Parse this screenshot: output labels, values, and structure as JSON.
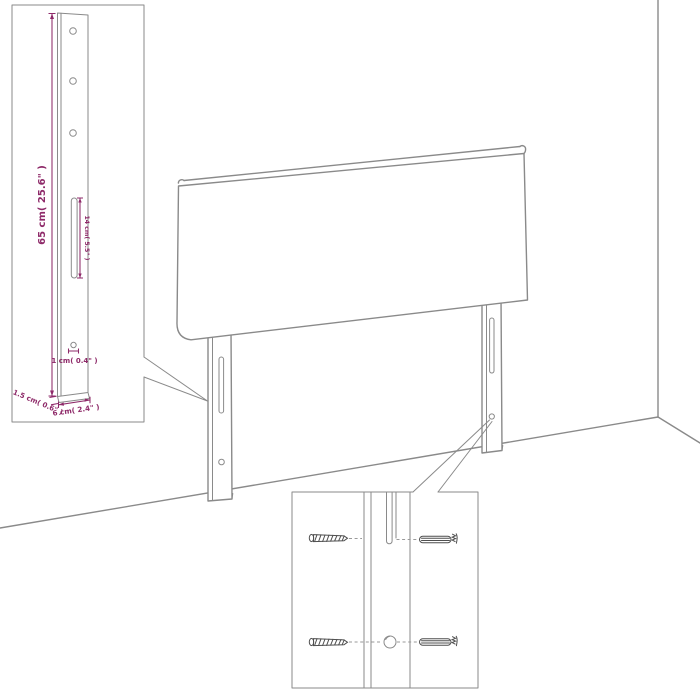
{
  "diagram": {
    "kind": "headboard assembly / dimension diagram",
    "colors": {
      "accent": "#8e2a69",
      "line": "#8a8a8a"
    },
    "bracket_detail": {
      "height_label": "65 cm( 25.6\" )",
      "slot_label": "14 cm( 5.5\" )",
      "hole_label": "1 cm( 0.4\" )",
      "thickness_label": "1.5 cm( 0.6\" )",
      "width_label": "6 cm( 2.4\" )"
    }
  }
}
